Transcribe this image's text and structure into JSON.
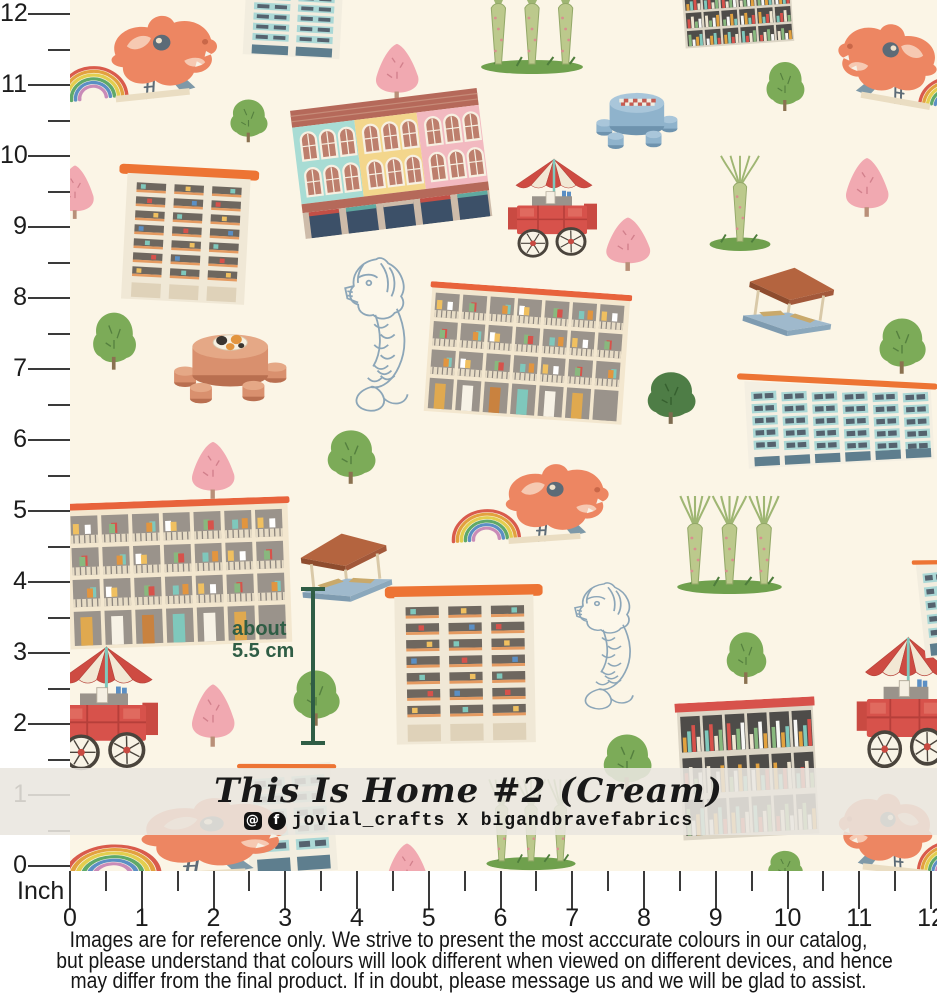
{
  "product": {
    "title": "This Is Home #2 (Cream)",
    "collab": "jovial_crafts X bigandbravefabrics",
    "icons": [
      "instagram-icon",
      "facebook-icon"
    ]
  },
  "annotation": {
    "line1": "about",
    "line2": "5.5 cm",
    "color": "#2F5D45"
  },
  "ruler": {
    "unit_label": "Inch",
    "vertical_numbers": [
      "0",
      "1",
      "2",
      "3",
      "4",
      "5",
      "6",
      "7",
      "8",
      "9",
      "10",
      "11",
      "12"
    ],
    "horizontal_numbers": [
      "0",
      "1",
      "2",
      "3",
      "4",
      "5",
      "6",
      "7",
      "8",
      "9",
      "10",
      "11",
      "12"
    ]
  },
  "disclaimer": {
    "lines": [
      "Images are for reference only. We strive to present the most acccurate colours in our catalog,",
      "but please understand that colours will look different when viewed on different devices, and hence",
      "may differ from the final product. If in doubt, please message us and we will be glad to assist."
    ]
  },
  "colors": {
    "fabric_bg": "#FBF5E6",
    "orange": "#ED7434",
    "dragon_orange": "#ED8662",
    "cart_red": "#D7524B",
    "teal_window": "#ABD8D6",
    "slate": "#55626E",
    "brick": "#B5695A",
    "banner": "#E9E6DF",
    "measure_green": "#2F5D45",
    "tree_green": "#7CAB58",
    "tree_pink": "#F1A9B1",
    "merlion_line": "#8CA6B8"
  },
  "fabric": {
    "elements": [
      {
        "name": "motif-dragon-playground-top-left",
        "type": "dragon",
        "x": 52,
        "y": 8,
        "w": 175,
        "h": 100,
        "rot": -6
      },
      {
        "name": "motif-hdb-teal-top",
        "type": "hdb_teal_tall",
        "x": 238,
        "y": -20,
        "w": 110,
        "h": 78,
        "rot": 3
      },
      {
        "name": "motif-supertrees-top",
        "type": "supertrees",
        "x": 476,
        "y": -32,
        "w": 112,
        "h": 108,
        "rot": 0
      },
      {
        "name": "motif-bookshelf-building-top-right",
        "type": "bookshelf",
        "x": 682,
        "y": -14,
        "w": 112,
        "h": 60,
        "rot": -4,
        "roof": "#BBB4A8"
      },
      {
        "name": "motif-dragon-playground-top-right",
        "type": "dragon",
        "x": 828,
        "y": 18,
        "w": 165,
        "h": 96,
        "rot": 10,
        "flip": true
      },
      {
        "name": "motif-tree-green-1",
        "type": "tree_green",
        "x": 762,
        "y": 58,
        "w": 46,
        "h": 55
      },
      {
        "name": "motif-tree-pink-1",
        "type": "tree_pink",
        "x": 366,
        "y": 38,
        "w": 62,
        "h": 64
      },
      {
        "name": "motif-tree-green-2",
        "type": "tree_green",
        "x": 226,
        "y": 96,
        "w": 45,
        "h": 48
      },
      {
        "name": "motif-shophouse",
        "type": "shophouse",
        "x": 295,
        "y": 96,
        "w": 192,
        "h": 132,
        "rot": -7
      },
      {
        "name": "motif-chess-table",
        "type": "chess_table",
        "x": 592,
        "y": 78,
        "w": 88,
        "h": 78
      },
      {
        "name": "motif-hdb-block-1",
        "type": "hdb_cream",
        "x": 116,
        "y": 166,
        "w": 140,
        "h": 138,
        "rot": 3
      },
      {
        "name": "motif-food-cart-1",
        "type": "food_cart",
        "x": 502,
        "y": 152,
        "w": 100,
        "h": 107
      },
      {
        "name": "motif-supertree-single",
        "type": "supertree_single",
        "x": 702,
        "y": 148,
        "w": 76,
        "h": 105
      },
      {
        "name": "motif-tree-pink-2",
        "type": "tree_pink",
        "x": 836,
        "y": 152,
        "w": 62,
        "h": 66
      },
      {
        "name": "motif-tree-pink-left-edge",
        "type": "tree_pink",
        "x": 48,
        "y": 160,
        "w": 54,
        "h": 60
      },
      {
        "name": "motif-tree-pink-3",
        "type": "tree_pink",
        "x": 596,
        "y": 212,
        "w": 64,
        "h": 60
      },
      {
        "name": "motif-merlion-1",
        "type": "merlion",
        "x": 342,
        "y": 252,
        "w": 86,
        "h": 165
      },
      {
        "name": "motif-hdb-laundry-1",
        "type": "hdb_laundry",
        "x": 426,
        "y": 288,
        "w": 202,
        "h": 132,
        "rot": 4
      },
      {
        "name": "motif-pavilion-1",
        "type": "pavilion",
        "x": 742,
        "y": 262,
        "w": 96,
        "h": 76,
        "rot": 8
      },
      {
        "name": "motif-tree-green-3",
        "type": "tree_green",
        "x": 88,
        "y": 308,
        "w": 52,
        "h": 64
      },
      {
        "name": "motif-round-table-cat",
        "type": "clay_table",
        "x": 168,
        "y": 316,
        "w": 122,
        "h": 96
      },
      {
        "name": "motif-tree-dark-1",
        "type": "tree_dark",
        "x": 642,
        "y": 368,
        "w": 58,
        "h": 58
      },
      {
        "name": "motif-hdb-teal-wide",
        "type": "hdb_teal_wide",
        "x": 738,
        "y": 356,
        "w": 202,
        "h": 114,
        "rot": -3
      },
      {
        "name": "motif-tree-green-4",
        "type": "tree_green",
        "x": 874,
        "y": 314,
        "w": 56,
        "h": 62
      },
      {
        "name": "motif-tree-pink-4",
        "type": "tree_pink",
        "x": 182,
        "y": 436,
        "w": 62,
        "h": 64
      },
      {
        "name": "motif-tree-green-5",
        "type": "tree_green",
        "x": 322,
        "y": 426,
        "w": 58,
        "h": 60
      },
      {
        "name": "motif-dragon-playground-center",
        "type": "dragon",
        "x": 448,
        "y": 456,
        "w": 170,
        "h": 94,
        "rot": -4
      },
      {
        "name": "motif-hdb-laundry-2",
        "type": "hdb_laundry",
        "x": 66,
        "y": 500,
        "w": 226,
        "h": 148,
        "rot": -2
      },
      {
        "name": "motif-supertrees-2",
        "type": "supertrees",
        "x": 672,
        "y": 488,
        "w": 115,
        "h": 108
      },
      {
        "name": "motif-pavilion-2",
        "type": "pavilion",
        "x": 296,
        "y": 528,
        "w": 98,
        "h": 76,
        "rot": -6
      },
      {
        "name": "motif-hdb-block-reference",
        "type": "hdb_cream",
        "x": 386,
        "y": 584,
        "w": 158,
        "h": 162,
        "rot": -1
      },
      {
        "name": "motif-merlion-2",
        "type": "merlion",
        "x": 572,
        "y": 578,
        "w": 80,
        "h": 136
      },
      {
        "name": "motif-tree-green-6",
        "type": "tree_green",
        "x": 722,
        "y": 628,
        "w": 48,
        "h": 58
      },
      {
        "name": "motif-food-cart-left-edge",
        "type": "food_cart",
        "x": 44,
        "y": 638,
        "w": 120,
        "h": 134
      },
      {
        "name": "motif-tree-pink-5",
        "type": "tree_pink",
        "x": 182,
        "y": 678,
        "w": 62,
        "h": 70
      },
      {
        "name": "motif-tree-green-7",
        "type": "tree_green",
        "x": 288,
        "y": 666,
        "w": 56,
        "h": 62
      },
      {
        "name": "motif-tree-green-8",
        "type": "tree_green",
        "x": 598,
        "y": 730,
        "w": 58,
        "h": 62
      },
      {
        "name": "motif-bookshelf-building-2",
        "type": "bookshelf",
        "x": 678,
        "y": 700,
        "w": 140,
        "h": 140,
        "rot": -3,
        "roof": "#D7524B"
      },
      {
        "name": "motif-food-cart-right-edge",
        "type": "food_cart",
        "x": 850,
        "y": 628,
        "w": 112,
        "h": 142
      },
      {
        "name": "motif-hdb-teal-right-edge",
        "type": "hdb_teal_tall",
        "x": 916,
        "y": 552,
        "w": 70,
        "h": 105,
        "rot": -6
      },
      {
        "name": "motif-hdb-teal-banner",
        "type": "hdb_teal_tall",
        "x": 240,
        "y": 755,
        "w": 100,
        "h": 120,
        "rot": -4
      },
      {
        "name": "motif-dragon-playground-bottom-left",
        "type": "dragon",
        "x": 60,
        "y": 790,
        "w": 240,
        "h": 96,
        "rot": -3
      },
      {
        "name": "motif-supertrees-3",
        "type": "supertrees",
        "x": 482,
        "y": 772,
        "w": 98,
        "h": 100
      },
      {
        "name": "motif-tree-pink-6",
        "type": "tree_pink",
        "x": 378,
        "y": 838,
        "w": 58,
        "h": 60
      },
      {
        "name": "motif-dragon-playground-bottom-right",
        "type": "dragon",
        "x": 830,
        "y": 786,
        "w": 155,
        "h": 96,
        "rot": 6,
        "flip": true
      },
      {
        "name": "motif-tree-green-9",
        "type": "tree_green",
        "x": 764,
        "y": 848,
        "w": 42,
        "h": 40
      }
    ]
  }
}
